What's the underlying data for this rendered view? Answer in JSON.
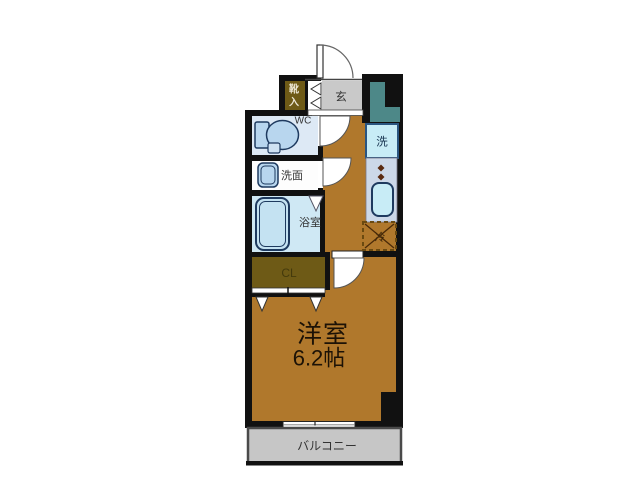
{
  "colors": {
    "wall": "#111111",
    "floor_brown": "#b0782c",
    "closet_olive": "#6e5a16",
    "hall_gray": "#c9c9c9",
    "duct_teal": "#4d8888",
    "wc_fill": "#dde9f5",
    "washroom_fill": "#fdfdfd",
    "bath_fill": "#cfe8f4",
    "fixture_fill": "#b8d6ee",
    "fixture_border": "#1e3a5f",
    "washer_fill": "#c8ecf6",
    "washer_border": "#2a5580",
    "counter_fill": "#ccd8e8",
    "balcony_fill": "#c6c6c6",
    "balcony_border": "#4a4a4a",
    "fridge_dash": "#6b4a10",
    "burner": "#5a2a10"
  },
  "rooms": {
    "entrance_hall": {
      "label": "玄"
    },
    "shoe_cabinet": {
      "label": "靴入",
      "label_lines": [
        "靴",
        "入"
      ]
    },
    "wc": {
      "label": "WC"
    },
    "washroom": {
      "label": "洗面"
    },
    "bathroom": {
      "label": "浴室"
    },
    "closet": {
      "label": "CL"
    },
    "washing_machine": {
      "label": "洗"
    },
    "refrigerator": {
      "label": "冷"
    },
    "main_room": {
      "label": "洋室",
      "size": "6.2帖"
    },
    "balcony": {
      "label": "バルコニー"
    }
  }
}
